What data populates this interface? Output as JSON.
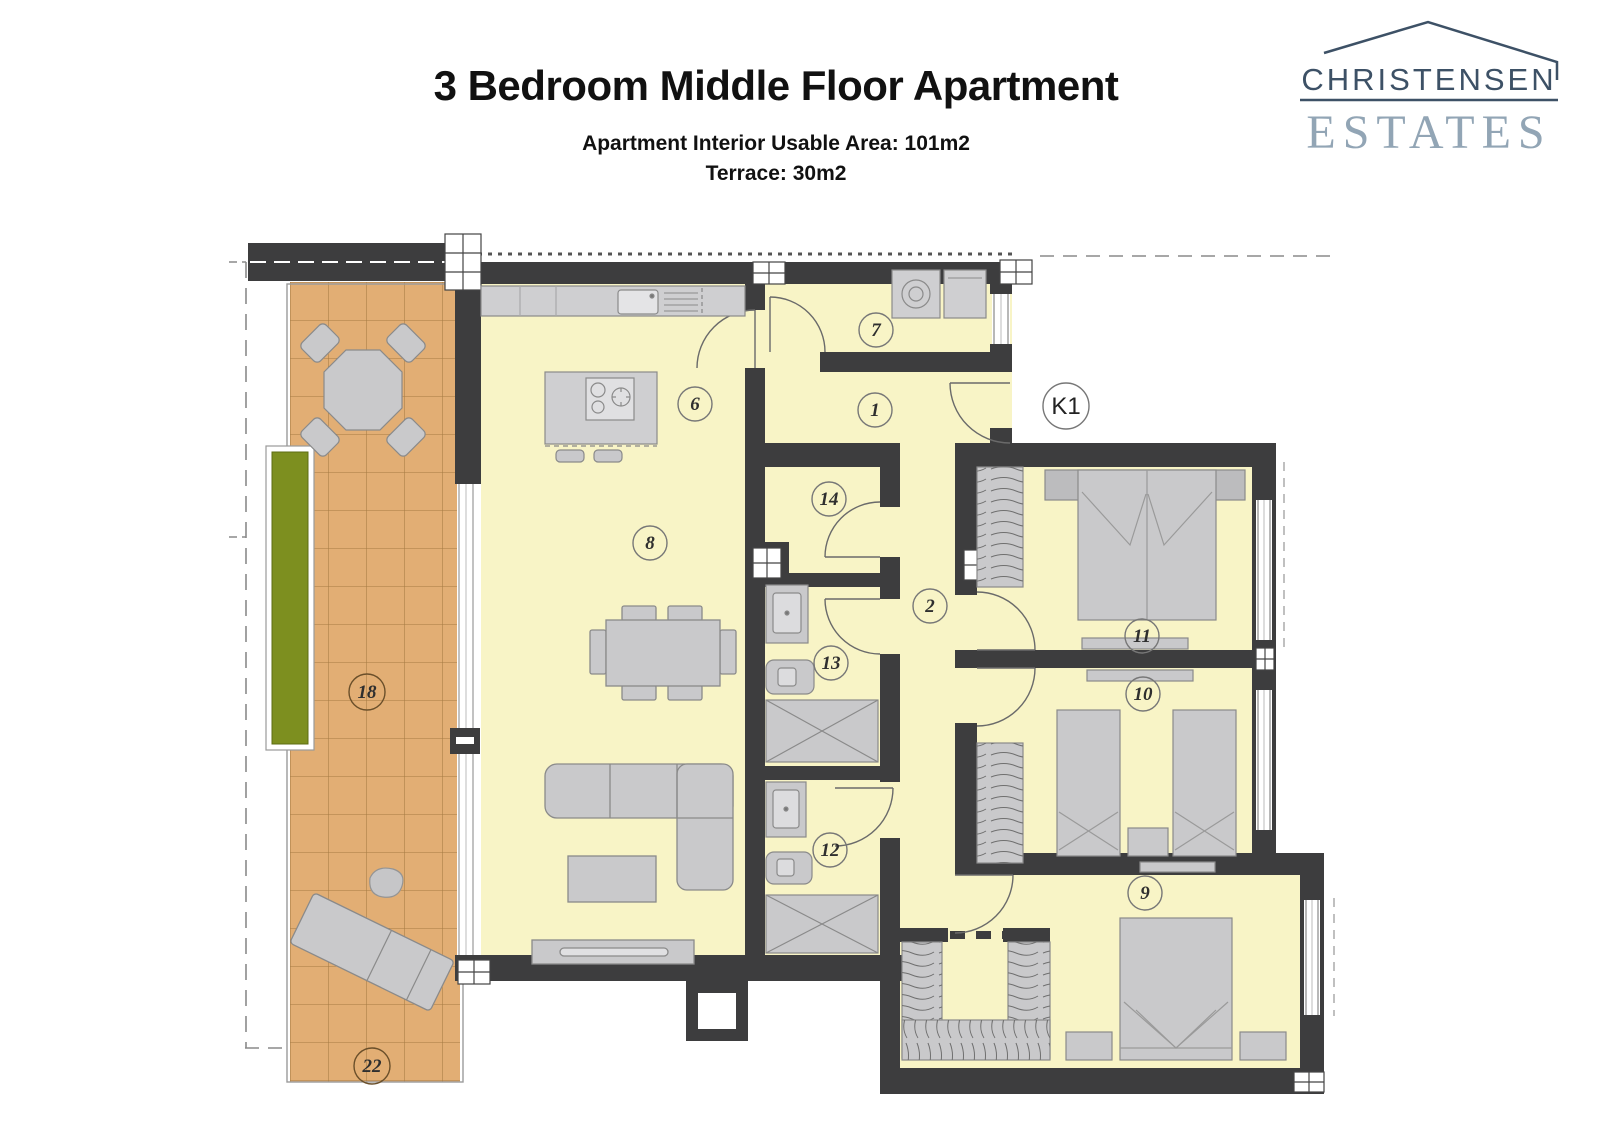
{
  "header": {
    "title": "3 Bedroom Middle Floor Apartment",
    "subtitle_line1": "Apartment Interior Usable Area: 101m2",
    "subtitle_line2": "Terrace: 30m2"
  },
  "logo": {
    "line1": "CHRISTENSEN",
    "line2": "ESTATES"
  },
  "plan": {
    "unit_label": "K1",
    "room_labels": [
      {
        "id": "entry-hall",
        "label": "1"
      },
      {
        "id": "hallway",
        "label": "2"
      },
      {
        "id": "kitchen",
        "label": "6"
      },
      {
        "id": "utility-room",
        "label": "7"
      },
      {
        "id": "living-dining",
        "label": "8"
      },
      {
        "id": "bedroom-3",
        "label": "9"
      },
      {
        "id": "bedroom-2",
        "label": "10"
      },
      {
        "id": "bedroom-1",
        "label": "11"
      },
      {
        "id": "bathroom-2",
        "label": "12"
      },
      {
        "id": "bathroom-1",
        "label": "13"
      },
      {
        "id": "storage",
        "label": "14"
      },
      {
        "id": "terrace",
        "label": "18"
      },
      {
        "id": "terrace-lower",
        "label": "22"
      }
    ],
    "colors": {
      "wall": "#3d3d3e",
      "interior_floor": "#f8f4c6",
      "terrace_floor": "#e2ae74",
      "furniture": "#c9c9cb",
      "counter": "#cfcfd1",
      "planter_green": "#7d8f1f",
      "logo_dark": "#3d5166",
      "logo_light": "#92a5b5"
    }
  }
}
